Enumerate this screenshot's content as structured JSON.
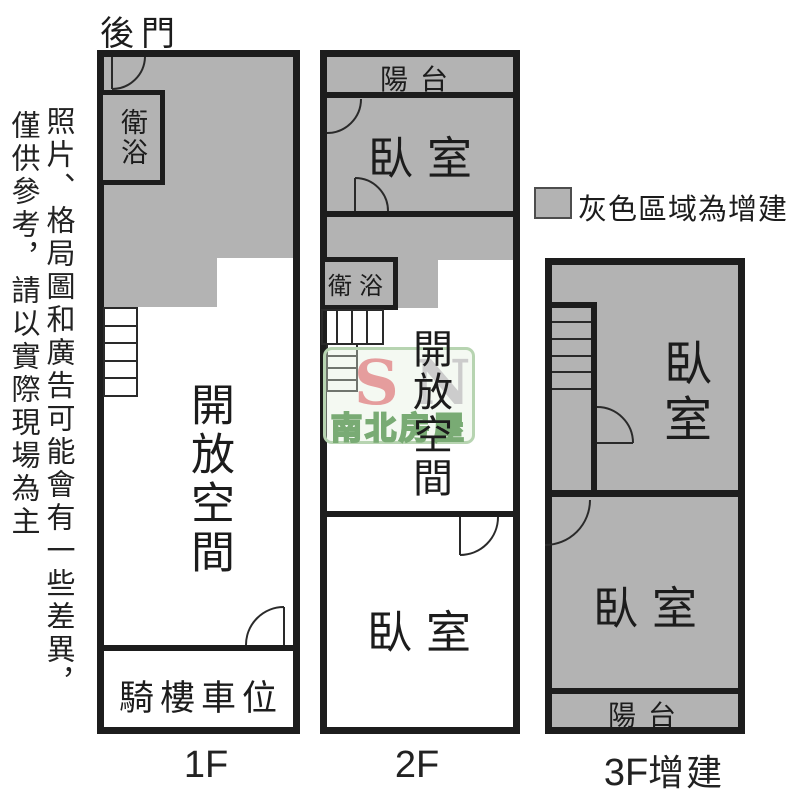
{
  "disclaimer": {
    "column_right": "照片、格局圖和廣告可能會有一些差異，",
    "column_left": "僅供參考，請以實際現場為主"
  },
  "back_door_label": "後門",
  "legend": {
    "label": "灰色區域為增建"
  },
  "watermark": {
    "s": "S",
    "n": "N",
    "brand": "南北房屋"
  },
  "colors": {
    "addition_gray": "#b3b3b3",
    "wall": "#1d1d1d",
    "thin_line": "#2a2a2a",
    "watermark_green": "#79ab74",
    "watermark_pink": "#e59d9d",
    "watermark_n_gray": "#cccccc"
  },
  "floors": {
    "f1": {
      "label": "1F",
      "rooms": {
        "bathroom": "衛浴",
        "open_space": "開放空間",
        "parking": "騎樓車位"
      }
    },
    "f2": {
      "label": "2F",
      "rooms": {
        "balcony": "陽台",
        "bedroom_upper": "臥室",
        "bathroom": "衛浴",
        "open_space": "開放空間",
        "bedroom_lower": "臥室"
      }
    },
    "f3": {
      "label_prefix": "3F",
      "label_suffix": "增建",
      "rooms": {
        "bedroom_upper": "臥室",
        "bedroom_lower": "臥室",
        "balcony": "陽台"
      }
    }
  }
}
